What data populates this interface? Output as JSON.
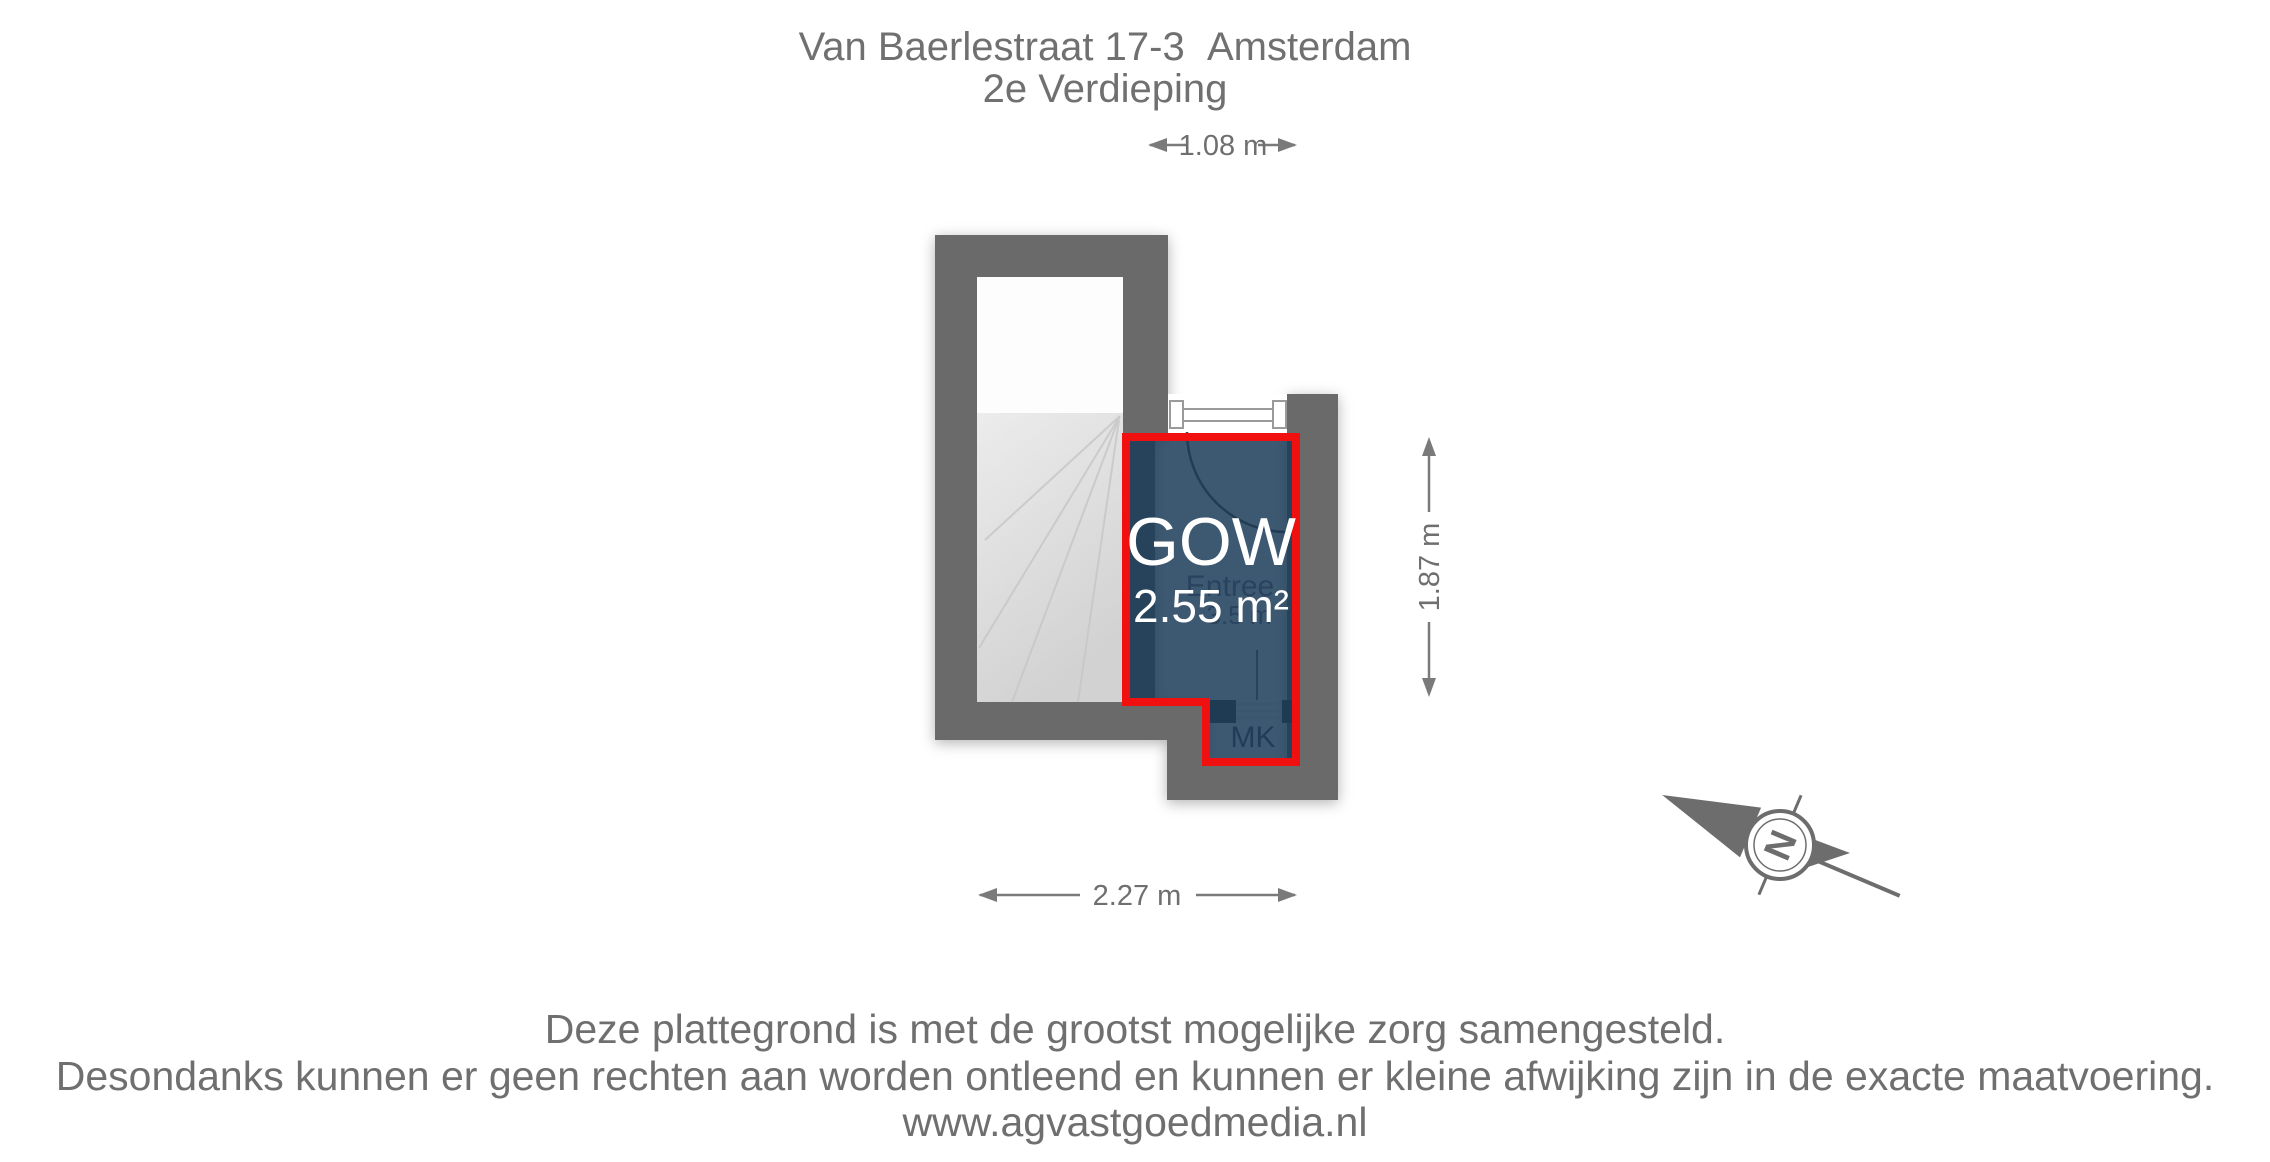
{
  "title": {
    "line1": "Van Baerlestraat 17-3  Amsterdam",
    "line2": "2e Verdieping"
  },
  "dimensions": {
    "width_top": "1.08 m",
    "height_right": "1.87 m",
    "width_bottom": "2.27 m"
  },
  "room": {
    "code": "GOW",
    "area": "2.55 m²",
    "base_label": "Entree",
    "base_area": "3.5 m",
    "closet_label": "MK"
  },
  "compass": {
    "north": "N"
  },
  "footer": {
    "line1": "Deze plattegrond is met de grootst mogelijke zorg samengesteld.",
    "line2": "Desondanks kunnen er geen rechten aan worden ontleend en kunnen er kleine afwijking zijn in de exacte maatvoering.",
    "line3": "www.agvastgoedmedia.nl"
  },
  "colors": {
    "wall": "#6b6b6b",
    "room_fill": "#1b3b58",
    "highlight_red": "#f01010",
    "text_gray": "#6f6f6f",
    "stairs_gray": "#d9d9d9"
  }
}
